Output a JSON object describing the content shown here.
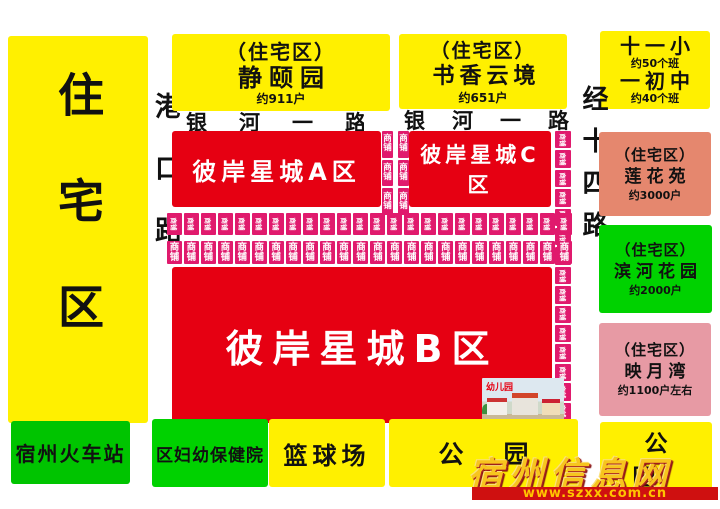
{
  "map_title": "彼岸星城小区位置示意图",
  "blocks": {
    "left_residential": {
      "label": "住宅区"
    },
    "jingyiyuan": {
      "line1": "（住宅区）",
      "line2": "静颐园",
      "line3": "约911户"
    },
    "shuxiang": {
      "line1": "（住宅区）",
      "line2": "书香云境",
      "line3": "约651户"
    },
    "school": {
      "line1": "十一小",
      "line2": "约50个班",
      "line3": "一初中",
      "line4": "约40个班"
    },
    "zone_a": {
      "label": "彼岸星城A区"
    },
    "zone_c": {
      "label": "彼岸星城C区"
    },
    "zone_b": {
      "label": "彼岸星城B区"
    },
    "lianhuayuan": {
      "line1": "（住宅区）",
      "line2": "莲花苑",
      "line3": "约3000户"
    },
    "binhe": {
      "line1": "（住宅区）",
      "line2": "滨河花园",
      "line3": "约2000户"
    },
    "yingyuewan": {
      "line1": "（住宅区）",
      "line2": "映月湾",
      "line3": "约1100户左右"
    },
    "train_station": {
      "label": "宿州火车站"
    },
    "maternity_hospital": {
      "label": "区妇幼保健院"
    },
    "basketball_court": {
      "label": "篮球场"
    },
    "park_center": {
      "label": "公园"
    },
    "park_right": {
      "label": "公园"
    }
  },
  "roads": {
    "gangkou": {
      "label": "港口路"
    },
    "yinhe_left": {
      "label": "银河一路"
    },
    "yinhe_right": {
      "label": "银河一路"
    },
    "jingshisi": {
      "label": "经十四路"
    }
  },
  "shops": {
    "label": "商铺",
    "top_row_count": 24,
    "bottom_row_count": 24,
    "strip_cell_count": 3,
    "right_col_count": 15
  },
  "kindergarten": {
    "label": "幼儿园"
  },
  "watermark": {
    "title": "宿州信息网",
    "url": "www.szxx.com.cn"
  },
  "colors": {
    "zone_red": "#e60012",
    "block_yellow": "#fff000",
    "shop_magenta": "#e01a6d",
    "station_green": "#00c400",
    "hospital_green": "#00d200",
    "lianhuayuan_salmon": "#e5876e",
    "yingyuewan_rose": "#e79aa4",
    "watermark_gold": "#f7c51e",
    "watermark_band_red": "#cf1010"
  }
}
